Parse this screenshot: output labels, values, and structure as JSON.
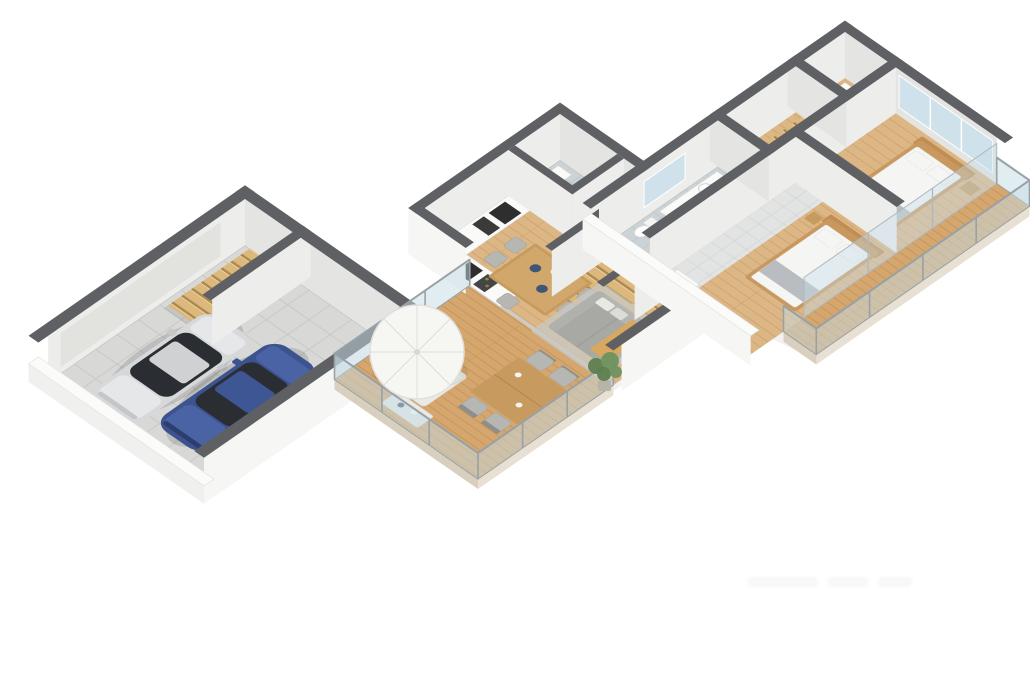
{
  "scene": {
    "type": "3d-floor-plan-render",
    "description": "Isometric 3D floor plan of a three-level house on a white background",
    "floors": [
      {
        "id": "garage-level",
        "label": "garage level",
        "rooms": [
          "garage",
          "staircase"
        ],
        "furniture": [
          "silver-car",
          "blue-car",
          "wooden-stairs"
        ]
      },
      {
        "id": "main-level",
        "label": "main living level",
        "rooms": [
          "kitchen",
          "dining-area",
          "living-room",
          "bathroom",
          "hall",
          "staircase",
          "terrace"
        ],
        "furniture": [
          "kitchen-counters",
          "dining-table",
          "six-chairs",
          "gray-sofa",
          "rug",
          "parasol",
          "sun-loungers",
          "outdoor-dining-set",
          "low-table",
          "potted-plant"
        ]
      },
      {
        "id": "upper-level",
        "label": "upper bedroom level",
        "rooms": [
          "bedroom-1",
          "bedroom-2",
          "bathroom",
          "hallway",
          "closet",
          "staircase",
          "balcony"
        ],
        "furniture": [
          "double-bed-1",
          "double-bed-2",
          "nightstands",
          "wardrobe",
          "washbasin",
          "toilet",
          "washing-machine"
        ]
      }
    ]
  },
  "watermark": {
    "text": ""
  },
  "palette": {
    "background": "#ffffff",
    "wallTop": "#5e6063",
    "wallFaceLight": "#ededeb",
    "wallFaceShade": "#e4e4e2",
    "wallExterior": "#f6f6f4",
    "wallPlinth": "#f0f0ee",
    "slabEdge": "#e8e0d2",
    "slabEdgeDark": "#d9cfbe",
    "woodFloor": "#dcb685",
    "woodLine": "#c09055",
    "deckFloor": "#d5a76e",
    "deckLine": "#b3854c",
    "stairWood": "#dcb87c",
    "tileGarage": "#d8d8d6",
    "tileBath": "#ccd3d6",
    "tileHall": "#e2e4e3",
    "glass": "#c5dbe5",
    "glassFrame": "#97a1a6",
    "windowGlass": "#cfe2ec",
    "carSilver": "#d7d8da",
    "carSilverHi": "#e6e7e9",
    "carBlue": "#3c5390",
    "carBlueHi": "#4a63a4",
    "carGlass": "#2a2e33",
    "sofaGray": "#a8a8a4",
    "sofaBack": "#b5b5b1",
    "throwTan": "#d9a85f",
    "rugGray": "#c8c8c4",
    "bedFrame": "#c8985e",
    "bedLinen": "#f5f5f3",
    "bedRunner": "#b9bcc0",
    "chairGray": "#b6b6b2",
    "chairDark": "#8e8e8a",
    "tableWood": "#c79a5f",
    "counterWhite": "#fafaf8",
    "applianceDark": "#2e2e2e",
    "plantGreen": "#5d7f4e",
    "plantGreenHi": "#6f925d",
    "parasolWhite": "#f6f6f3"
  }
}
